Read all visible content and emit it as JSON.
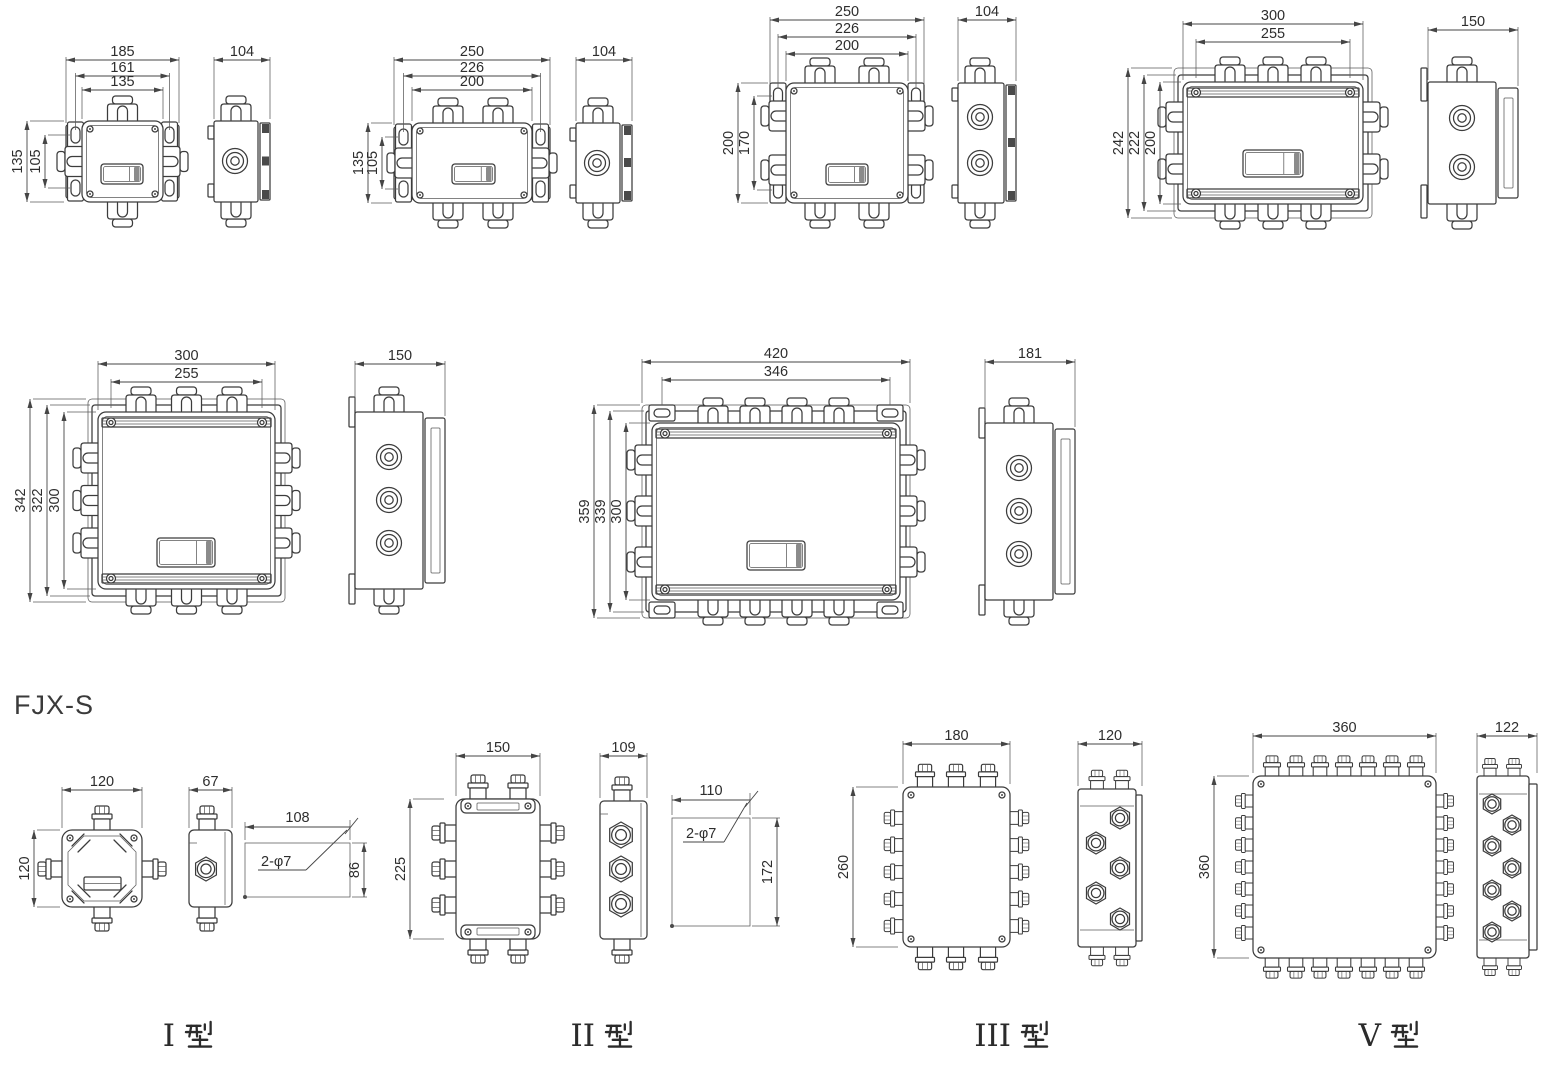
{
  "page": {
    "title": "FJX-S",
    "background": "#ffffff",
    "line_color": "#3c3c3c",
    "text_color": "#2d2d2d"
  },
  "figures": [
    {
      "id": "box-135",
      "dims_top": [
        "185",
        "161",
        "135"
      ],
      "dims_left": [
        "135",
        "105"
      ],
      "side_width": "104"
    },
    {
      "id": "box-200x135",
      "dims_top": [
        "250",
        "226",
        "200"
      ],
      "dims_left": [
        "135",
        "105"
      ],
      "side_width": "104"
    },
    {
      "id": "box-200x200",
      "dims_top": [
        "250",
        "226",
        "200"
      ],
      "dims_left": [
        "200",
        "170"
      ],
      "side_width": "104"
    },
    {
      "id": "box-300x200",
      "dims_top": [
        "300",
        "255"
      ],
      "dims_left": [
        "242",
        "222",
        "200"
      ],
      "side_width": "150"
    },
    {
      "id": "box-300x300",
      "dims_top": [
        "300",
        "255"
      ],
      "dims_left": [
        "342",
        "322",
        "300"
      ],
      "side_width": "150"
    },
    {
      "id": "box-420x300",
      "dims_top": [
        "420",
        "346"
      ],
      "dims_left": [
        "359",
        "339",
        "300"
      ],
      "side_width": "181"
    },
    {
      "id": "fjx-s-type-1",
      "caption": {
        "numeral": "Ⅰ",
        "suffix": "型"
      },
      "dims_top": [
        "120"
      ],
      "dims_left": [
        "120"
      ],
      "side_width": "67",
      "detail": {
        "width": "108",
        "height": "86",
        "note": "2-φ7"
      }
    },
    {
      "id": "fjx-s-type-2",
      "caption": {
        "numeral": "Ⅱ",
        "suffix": "型"
      },
      "dims_top": [
        "150"
      ],
      "dims_left": [
        "225"
      ],
      "side_width": "109",
      "detail": {
        "width": "110",
        "height": "172",
        "note": "2-φ7"
      }
    },
    {
      "id": "fjx-s-type-3",
      "caption": {
        "numeral": "Ⅲ",
        "suffix": "型"
      },
      "dims_top": [
        "180"
      ],
      "dims_left": [
        "260"
      ],
      "side_width": "120"
    },
    {
      "id": "fjx-s-type-5",
      "caption": {
        "numeral": "Ⅴ",
        "suffix": "型"
      },
      "dims_top": [
        "360"
      ],
      "dims_left": [
        "360"
      ],
      "side_width": "122"
    }
  ]
}
